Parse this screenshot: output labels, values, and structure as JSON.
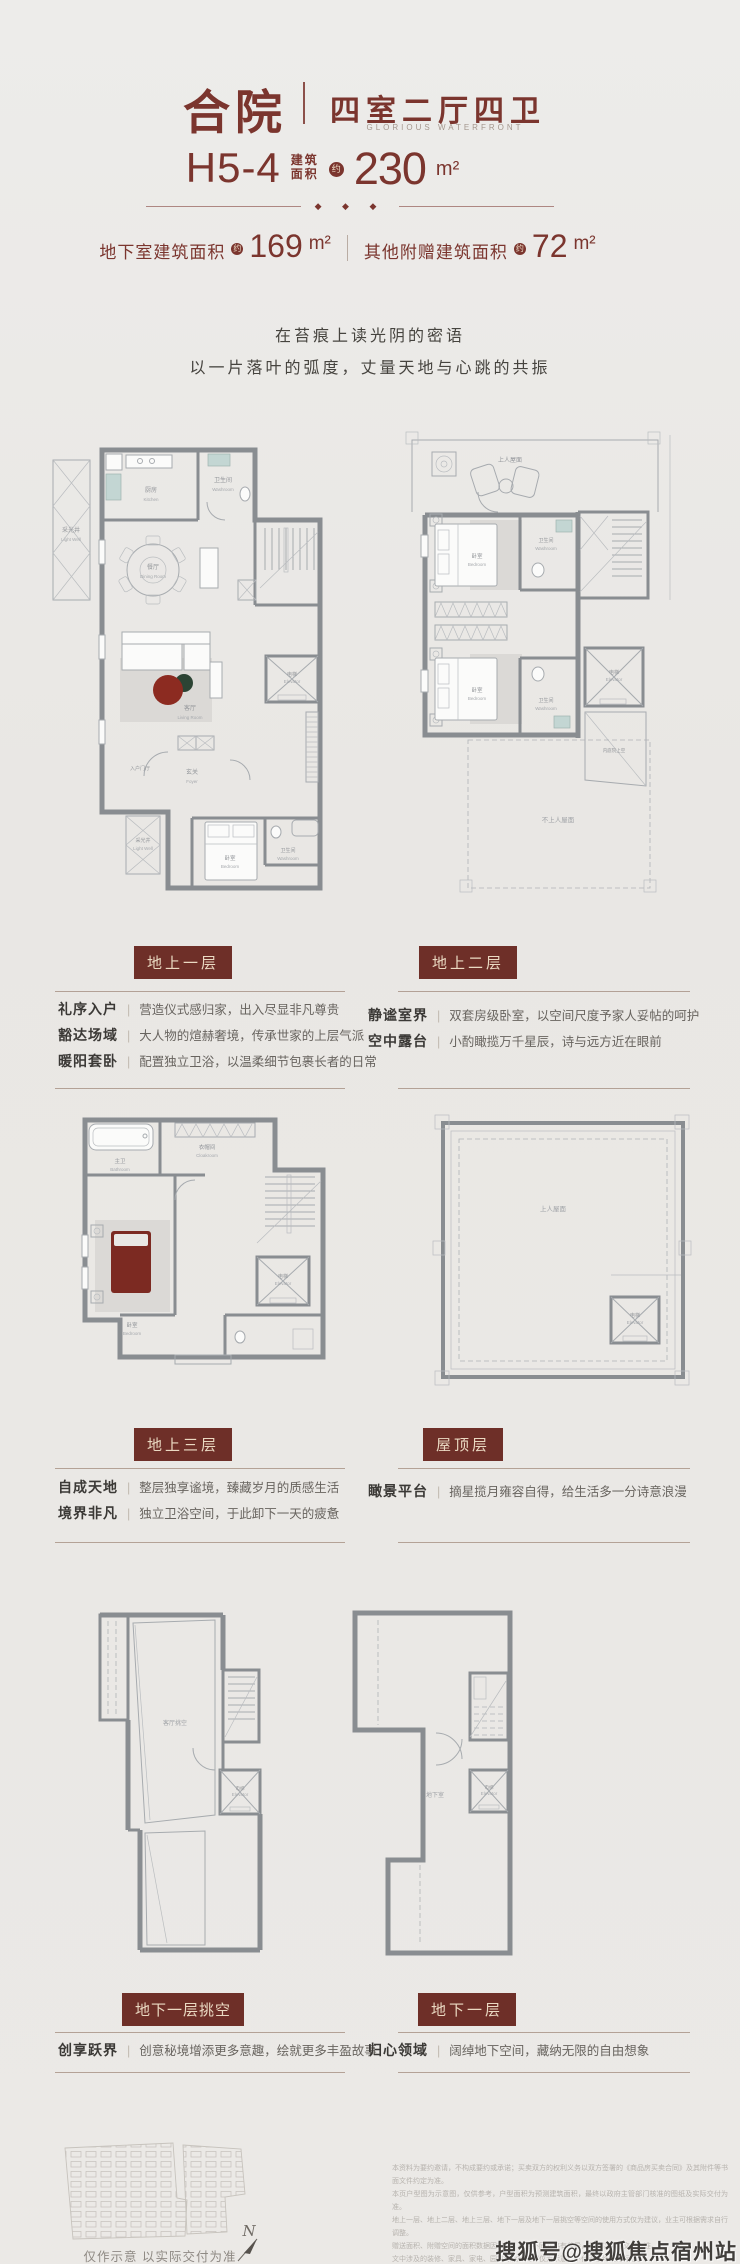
{
  "colors": {
    "maroon": "#7b352e",
    "badge_bg": "#6e2f28",
    "badge_text": "#ead9c2",
    "wall_gray": "#898d91",
    "rug_red": "#8c2b21",
    "rug_green": "#2c4434"
  },
  "header": {
    "title": "合院",
    "layout": "四室二厅四卫",
    "subtitle_en": "GLORIOUS  WATERFRONT",
    "model": "H5-4",
    "area_prefix_line1": "建筑",
    "area_prefix_line2": "面积",
    "approx": "约",
    "area_value": "230",
    "area_unit": "m²",
    "diamonds": "◆ ◆ ◆",
    "sub_areas": [
      {
        "label": "地下室建筑面积",
        "approx": "约",
        "value": "169",
        "unit": "m²"
      },
      {
        "label": "其他附赠建筑面积",
        "approx": "约",
        "value": "72",
        "unit": "m²"
      }
    ],
    "poem": [
      "在苔痕上读光阴的密语",
      "以一片落叶的弧度，丈量天地与心跳的共振"
    ]
  },
  "floors": [
    {
      "badge": "地上一层",
      "features": [
        {
          "title": "礼序入户",
          "desc": "营造仪式感归家，出入尽显非凡尊贵"
        },
        {
          "title": "豁达场域",
          "desc": "大人物的煊赫奢境，传承世家的上层气派"
        },
        {
          "title": "暖阳套卧",
          "desc": "配置独立卫浴，以温柔细节包裹长者的日常"
        }
      ]
    },
    {
      "badge": "地上二层",
      "features": [
        {
          "title": "静谧室界",
          "desc": "双套房级卧室，以空间尺度予家人妥帖的呵护"
        },
        {
          "title": "空中露台",
          "desc": "小酌瞰揽万千星辰，诗与远方近在眼前"
        }
      ]
    },
    {
      "badge": "地上三层",
      "features": [
        {
          "title": "自成天地",
          "desc": "整层独享谧境，臻藏岁月的质感生活"
        },
        {
          "title": "境界非凡",
          "desc": "独立卫浴空间，于此卸下一天的疲惫"
        }
      ]
    },
    {
      "badge": "屋顶层",
      "features": [
        {
          "title": "瞰景平台",
          "desc": "摘星揽月雍容自得，给生活多一分诗意浪漫"
        }
      ]
    },
    {
      "badge": "地下一层挑空",
      "features": [
        {
          "title": "创享跃界",
          "desc": "创意秘境增添更多意趣，绘就更多丰盈故事"
        }
      ]
    },
    {
      "badge": "地下一层",
      "features": [
        {
          "title": "归心领域",
          "desc": "阔绰地下空间，藏纳无限的自由想象"
        }
      ]
    }
  ],
  "plans": {
    "p1": {
      "light_well": "采光井",
      "light_well_en": "Light Well",
      "kitchen": "厨房",
      "kitchen_en": "Kitchen",
      "wash_top": "卫生间",
      "wash_top_en": "Washroom",
      "dining": "餐厅",
      "dining_en": "Dining Room",
      "living": "客厅",
      "living_en": "Living Room",
      "elevator": "电梯",
      "elevator_en": "Elevator",
      "entry_hall": "入户门厅",
      "foyer": "玄关",
      "foyer_en": "Foyer",
      "light_well2": "采光井",
      "light_well2_en": "Light Well",
      "bedroom": "卧室",
      "bedroom_en": "Bedroom",
      "wash_bottom": "卫生间",
      "wash_bottom_en": "Washroom"
    },
    "p2": {
      "roof_terrace": "上人屋面",
      "bedroom1": "卧室",
      "bedroom1_en": "Bedroom",
      "bedroom2": "卧室",
      "bedroom2_en": "Bedroom",
      "wash1": "卫生间",
      "wash1_en": "Washroom",
      "wash2": "卫生间",
      "wash2_en": "Washroom",
      "elevator": "电梯",
      "elevator_en": "Elevator",
      "courtyard": "内庭院上空",
      "roof_lower": "不上人屋面"
    },
    "p3": {
      "bath": "主卫",
      "bath_en": "Bathroom",
      "cloak": "衣帽间",
      "cloak_en": "Cloakroom",
      "bedroom": "卧室",
      "bedroom_en": "Bedroom",
      "elevator": "电梯",
      "elevator_en": "Elevator"
    },
    "p4": {
      "roof": "上人屋面",
      "elevator": "电梯",
      "elevator_en": "Elevator"
    },
    "p5": {
      "void": "客厅挑空",
      "elevator": "电梯",
      "elevator_en": "Elevator"
    },
    "p6": {
      "basement": "地下室",
      "elevator": "电梯",
      "elevator_en": "Elevator"
    }
  },
  "footer": {
    "site_caption": "仅作示意 以实际交付为准",
    "north_label": "N",
    "disclaimer_lines": [
      "本资料为要约邀请，不构成要约或承诺；买卖双方的权利义务以双方签署的《商品房买卖合同》及其附件等书面文件约定为准。",
      "本页户型图为示意图，仅供参考，户型面积为预测建筑面积，最终以政府主管部门核准的图纸及实际交付为准。",
      "地上一层、地上二层、地上三层、地下一层及地下一层挑空等空间的使用方式仅为建议，业主可根据需求自行调整。",
      "赠送面积、附赠空间的面积数据因楼栋、楼层不同而略有差异，具体以实际交付为准。",
      "文中涉及的装修、家具、家电、园林绿化等内容仅为示意，不代表最终交付标准。",
      "因市场、政策等因素变化，相关信息可能调整，敬请留意最新公示信息；部分图片来源于网络，如有侵权请联系删除。",
      "本资料解释权归出卖人所有。"
    ],
    "watermark": "搜狐号@搜狐焦点宿州站"
  }
}
